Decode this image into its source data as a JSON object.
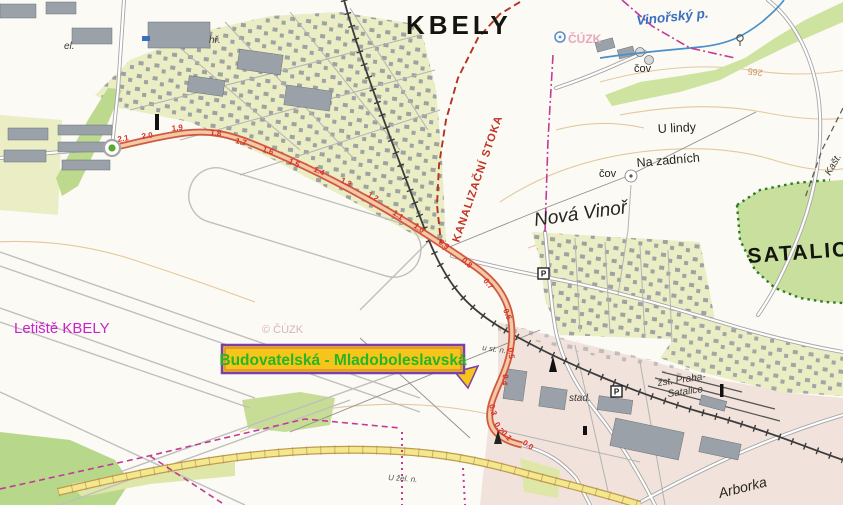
{
  "map": {
    "towns": {
      "kbely": "KBELY",
      "satalice": "SATALICE",
      "nova_vinor": "Nová Vinoř"
    },
    "places": {
      "letiste": "Letiště KBELY",
      "u_lindy": "U lindy",
      "na_zadnich": "Na zadních",
      "cov_top": "čov",
      "cov_mid": "čov",
      "zst_line1": "žst. Praha-",
      "zst_line2": "Satalice",
      "stad": "stad.",
      "arborka": "Arborka",
      "el": "el.",
      "hr": "hř.",
      "kast": "Kašt.",
      "u_zel": "U žel. n.",
      "us_n": "u st. n."
    },
    "water": {
      "stream": "Vinořský p."
    },
    "annotations": {
      "route_label": "Budovatelská - Mladoboleslavská",
      "kanalizacni": "KANALIZAČNÍ STOKA"
    },
    "contour_label": "265",
    "watermark_top": "ČÚZK",
    "watermark_center": "© ČÚZK",
    "parking_symbol": "P",
    "colors": {
      "route_red": "#d05a40",
      "route_fill": "#f3c9a8",
      "label_bg": "#f6c51a",
      "label_border": "#7a3fa8",
      "label_text": "#28b428",
      "boundary_magenta": "#c23c96",
      "stoka_red": "#b43222",
      "water_blue": "#4a90c8",
      "forest_green": "#c8df9d",
      "airport_label_magenta": "#cc22cc"
    },
    "route": {
      "chainage": [
        {
          "label": "2.1",
          "x": 118,
          "y": 142,
          "r": -10
        },
        {
          "label": "2.0",
          "x": 142,
          "y": 139,
          "r": -8
        },
        {
          "label": "1.9",
          "x": 172,
          "y": 131,
          "r": -6
        },
        {
          "label": "1.8",
          "x": 210,
          "y": 135,
          "r": 6
        },
        {
          "label": "1.7",
          "x": 235,
          "y": 143,
          "r": 14
        },
        {
          "label": "1.6",
          "x": 262,
          "y": 151,
          "r": 20
        },
        {
          "label": "1.5",
          "x": 288,
          "y": 163,
          "r": 24
        },
        {
          "label": "1.4",
          "x": 313,
          "y": 171,
          "r": 25
        },
        {
          "label": "1.3",
          "x": 340,
          "y": 182,
          "r": 27
        },
        {
          "label": "1.2",
          "x": 367,
          "y": 196,
          "r": 30
        },
        {
          "label": "1.1",
          "x": 392,
          "y": 214,
          "r": 34
        },
        {
          "label": "1.0",
          "x": 413,
          "y": 227,
          "r": 36
        },
        {
          "label": "0.9",
          "x": 438,
          "y": 243,
          "r": 38
        },
        {
          "label": "0.8",
          "x": 461,
          "y": 261,
          "r": 42
        },
        {
          "label": "0.7",
          "x": 483,
          "y": 281,
          "r": 52
        },
        {
          "label": "0.6",
          "x": 503,
          "y": 310,
          "r": 68
        },
        {
          "label": "0.5",
          "x": 508,
          "y": 348,
          "r": 84
        },
        {
          "label": "0.4",
          "x": 503,
          "y": 374,
          "r": 95
        },
        {
          "label": "0.3",
          "x": 489,
          "y": 405,
          "r": 75
        },
        {
          "label": "0.2",
          "x": 494,
          "y": 424,
          "r": 60
        },
        {
          "label": "0.1",
          "x": 501,
          "y": 433,
          "r": 48
        },
        {
          "label": "0.0",
          "x": 522,
          "y": 444,
          "r": 34
        }
      ]
    }
  }
}
